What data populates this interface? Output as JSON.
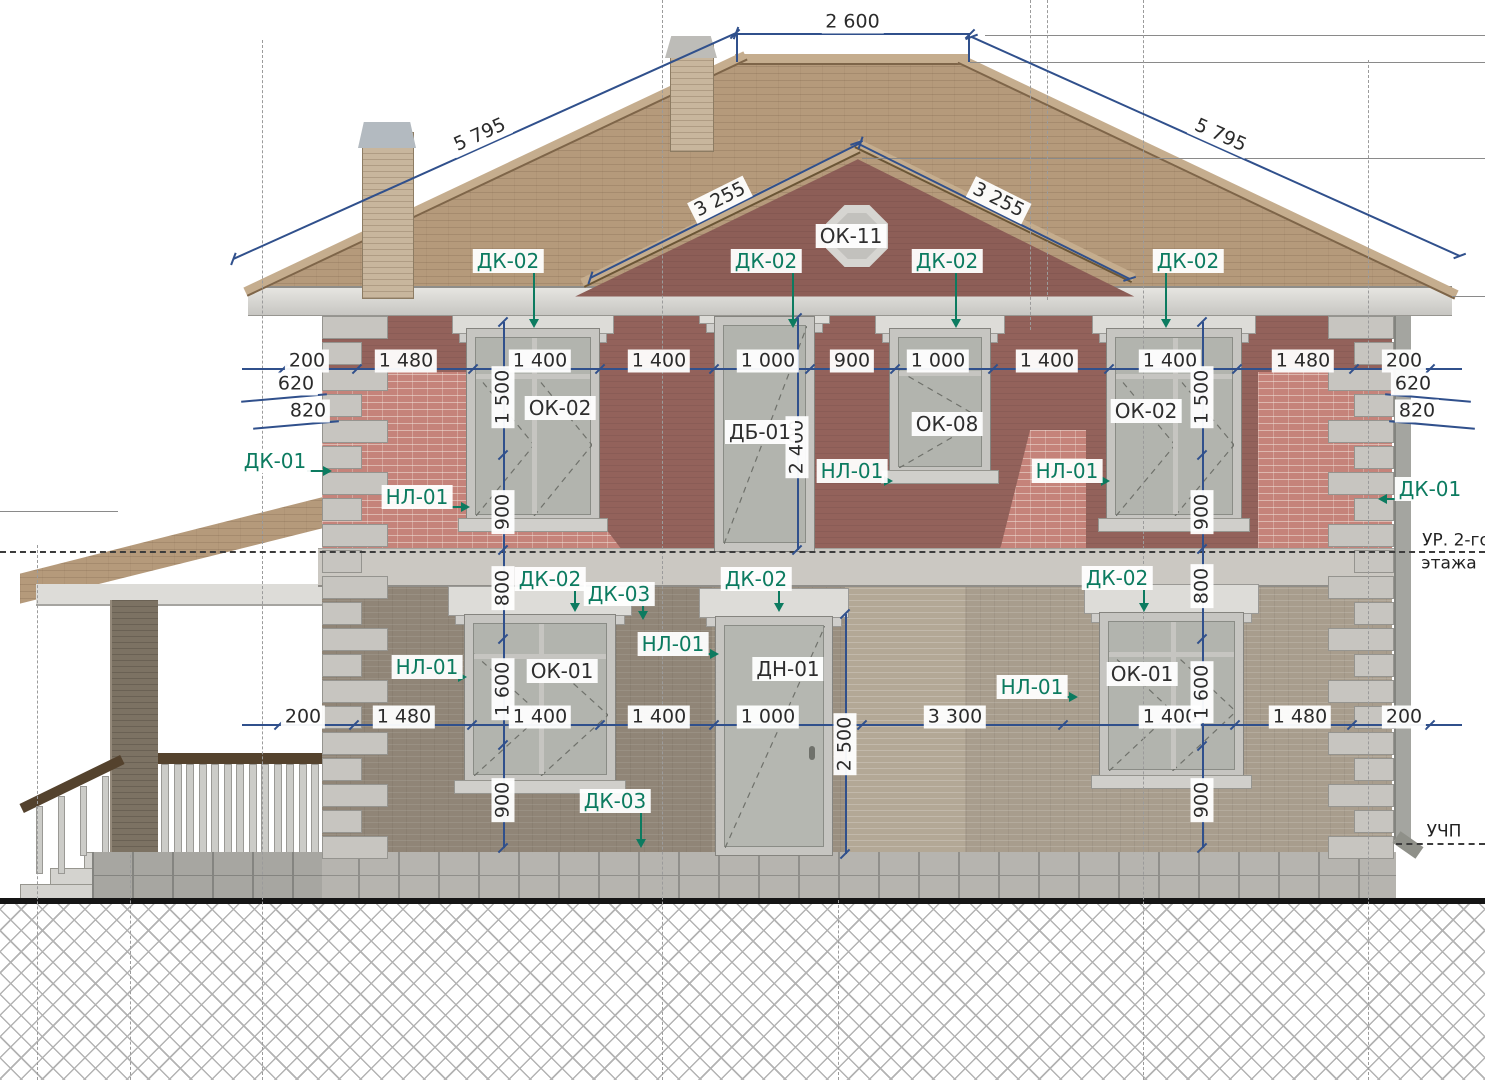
{
  "page": {
    "width": 1485,
    "height": 1080,
    "kind": "architectural facade elevation drawing"
  },
  "drawing": {
    "levels": {
      "floor2_line1": "УР. 2-го",
      "floor2_line2": "этажа",
      "ground": "УЧП"
    },
    "colors": {
      "dimension": "#30508c",
      "callout_green": "#0c7b60",
      "wall_upper": "#93625b",
      "wall_lower": "#a89d8d",
      "brick_accent": "#c5837a",
      "roof": "#b59a7b"
    },
    "element_tags": [
      {
        "text": "ОК-11",
        "x": 851,
        "y": 236
      },
      {
        "text": "ОК-02",
        "x": 560,
        "y": 408
      },
      {
        "text": "ДБ-01",
        "x": 760,
        "y": 432
      },
      {
        "text": "ОК-08",
        "x": 947,
        "y": 424
      },
      {
        "text": "ОК-02",
        "x": 1146,
        "y": 411
      },
      {
        "text": "ОК-01",
        "x": 562,
        "y": 671
      },
      {
        "text": "ДН-01",
        "x": 788,
        "y": 669
      },
      {
        "text": "ОК-01",
        "x": 1142,
        "y": 674
      }
    ],
    "callouts": [
      {
        "text": "ДК-02",
        "x": 508,
        "y": 261,
        "dir": "down",
        "tx": 533,
        "ty": 328
      },
      {
        "text": "ДК-02",
        "x": 766,
        "y": 261,
        "dir": "down",
        "tx": 792,
        "ty": 328
      },
      {
        "text": "ДК-02",
        "x": 947,
        "y": 261,
        "dir": "down",
        "tx": 955,
        "ty": 328
      },
      {
        "text": "ДК-02",
        "x": 1188,
        "y": 261,
        "dir": "down",
        "tx": 1165,
        "ty": 328
      },
      {
        "text": "ДК-01",
        "x": 275,
        "y": 461,
        "dir": "right",
        "tx": 332,
        "ty": 470
      },
      {
        "text": "НЛ-01",
        "x": 417,
        "y": 497,
        "dir": "right",
        "tx": 470,
        "ty": 506
      },
      {
        "text": "НЛ-01",
        "x": 852,
        "y": 471,
        "dir": "right",
        "tx": 893,
        "ty": 480
      },
      {
        "text": "НЛ-01",
        "x": 1067,
        "y": 471,
        "dir": "right",
        "tx": 1110,
        "ty": 480
      },
      {
        "text": "ДК-01",
        "x": 1430,
        "y": 489,
        "dir": "left",
        "tx": 1378,
        "ty": 498
      },
      {
        "text": "ДК-02",
        "x": 550,
        "y": 579,
        "dir": "down",
        "tx": 574,
        "ty": 612
      },
      {
        "text": "ДК-03",
        "x": 619,
        "y": 594,
        "dir": "down",
        "tx": 642,
        "ty": 620
      },
      {
        "text": "ДК-02",
        "x": 756,
        "y": 579,
        "dir": "down",
        "tx": 778,
        "ty": 612
      },
      {
        "text": "ДК-02",
        "x": 1117,
        "y": 578,
        "dir": "down",
        "tx": 1143,
        "ty": 612
      },
      {
        "text": "НЛ-01",
        "x": 427,
        "y": 667,
        "dir": "right",
        "tx": 467,
        "ty": 676
      },
      {
        "text": "НЛ-01",
        "x": 673,
        "y": 644,
        "dir": "right",
        "tx": 719,
        "ty": 653
      },
      {
        "text": "НЛ-01",
        "x": 1032,
        "y": 687,
        "dir": "right",
        "tx": 1078,
        "ty": 696
      },
      {
        "text": "ДК-03",
        "x": 615,
        "y": 801,
        "dir": "down",
        "tx": 640,
        "ty": 848
      }
    ],
    "dims_sloped": [
      {
        "text": "2 600",
        "x1": 735,
        "y1": 33,
        "x2": 970,
        "y2": 33
      },
      {
        "text": "5 795",
        "x1": 233,
        "y1": 258,
        "x2": 736,
        "y2": 32
      },
      {
        "text": "5 795",
        "x1": 972,
        "y1": 36,
        "x2": 1460,
        "y2": 255
      },
      {
        "text": "3 255",
        "x1": 590,
        "y1": 277,
        "x2": 860,
        "y2": 142
      },
      {
        "text": "3 255",
        "x1": 857,
        "y1": 142,
        "x2": 1130,
        "y2": 278
      }
    ],
    "dim_rows": [
      {
        "y": 368,
        "x1": 242,
        "x2": 1462,
        "labels": [
          {
            "t": "200",
            "x": 307
          },
          {
            "t": "1 480",
            "x": 406
          },
          {
            "t": "1 400",
            "x": 540
          },
          {
            "t": "1 400",
            "x": 659
          },
          {
            "t": "1 000",
            "x": 768
          },
          {
            "t": "900",
            "x": 852
          },
          {
            "t": "1 000",
            "x": 938
          },
          {
            "t": "1 400",
            "x": 1047
          },
          {
            "t": "1 400",
            "x": 1170
          },
          {
            "t": "1 480",
            "x": 1303
          },
          {
            "t": "200",
            "x": 1404
          }
        ]
      },
      {
        "y": 724,
        "x1": 242,
        "x2": 1462,
        "labels": [
          {
            "t": "200",
            "x": 303
          },
          {
            "t": "1 480",
            "x": 404
          },
          {
            "t": "1 400",
            "x": 540
          },
          {
            "t": "1 400",
            "x": 659
          },
          {
            "t": "1 000",
            "x": 768
          },
          {
            "t": "3 300",
            "x": 955
          },
          {
            "t": "1 400",
            "x": 1170
          },
          {
            "t": "1 480",
            "x": 1300
          },
          {
            "t": "200",
            "x": 1404
          }
        ]
      }
    ],
    "dim_cols": [
      {
        "x": 503,
        "y1": 322,
        "y2": 848,
        "labels": [
          {
            "t": "1 500",
            "y": 397
          },
          {
            "t": "900",
            "y": 512
          },
          {
            "t": "800",
            "y": 588
          },
          {
            "t": "1 600",
            "y": 689
          },
          {
            "t": "900",
            "y": 800
          }
        ]
      },
      {
        "x": 1202,
        "y1": 322,
        "y2": 848,
        "labels": [
          {
            "t": "1 500",
            "y": 397
          },
          {
            "t": "900",
            "y": 512
          },
          {
            "t": "800",
            "y": 586
          },
          {
            "t": "1 600",
            "y": 692
          },
          {
            "t": "900",
            "y": 800
          }
        ]
      },
      {
        "x": 797,
        "y1": 318,
        "y2": 550,
        "labels": [
          {
            "t": "2 400",
            "y": 447
          }
        ]
      },
      {
        "x": 845,
        "y1": 614,
        "y2": 854,
        "labels": [
          {
            "t": "2 500",
            "y": 744
          }
        ]
      }
    ],
    "dims_side": [
      {
        "t": "620",
        "x": 296,
        "y": 384,
        "side": "L"
      },
      {
        "t": "820",
        "x": 308,
        "y": 411,
        "side": "L"
      },
      {
        "t": "620",
        "x": 1413,
        "y": 384,
        "side": "R"
      },
      {
        "t": "820",
        "x": 1417,
        "y": 411,
        "side": "R"
      }
    ]
  }
}
